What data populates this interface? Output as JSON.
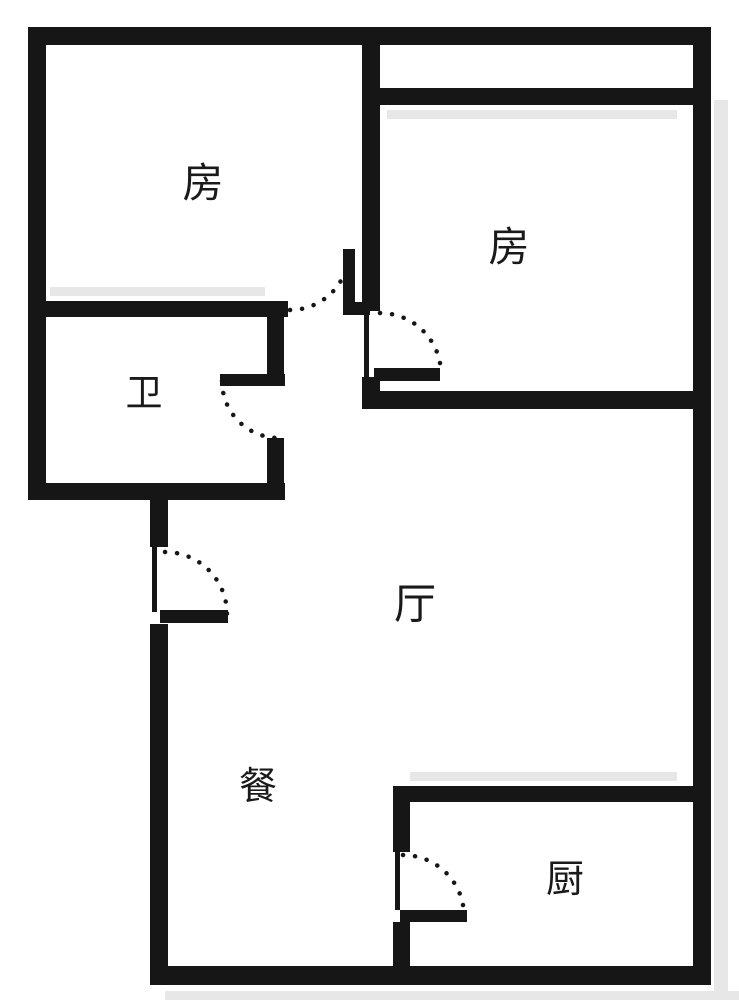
{
  "floor_plan": {
    "type": "apartment-floor-plan",
    "canvas": {
      "width": 739,
      "height": 1000
    },
    "colors": {
      "background": "#ffffff",
      "wall": "#161616",
      "shadow": "#e7e7e7",
      "text": "#1a1a1a"
    },
    "rooms": [
      {
        "id": "bedroom-left",
        "label": "房",
        "x": 203,
        "y": 183,
        "font": 41
      },
      {
        "id": "bedroom-right",
        "label": "房",
        "x": 509,
        "y": 247,
        "font": 41
      },
      {
        "id": "bathroom",
        "label": "卫",
        "x": 144,
        "y": 393,
        "font": 37
      },
      {
        "id": "living-room",
        "label": "厅",
        "x": 415,
        "y": 604,
        "font": 42
      },
      {
        "id": "dining",
        "label": "餐",
        "x": 258,
        "y": 787,
        "font": 38
      },
      {
        "id": "kitchen",
        "label": "厨",
        "x": 565,
        "y": 880,
        "font": 38
      }
    ],
    "walls": [
      {
        "name": "outer-wall-top",
        "x": 28,
        "y": 27,
        "w": 683,
        "h": 18
      },
      {
        "name": "outer-wall-left",
        "x": 28,
        "y": 27,
        "w": 18,
        "h": 473
      },
      {
        "name": "outer-wall-right",
        "x": 693,
        "y": 27,
        "w": 18,
        "h": 958
      },
      {
        "name": "outer-wall-bottom",
        "x": 150,
        "y": 966,
        "w": 561,
        "h": 19
      },
      {
        "name": "hall-left-wall-upper",
        "x": 150,
        "y": 483,
        "w": 18,
        "h": 64
      },
      {
        "name": "hall-left-wall-lower",
        "x": 150,
        "y": 624,
        "w": 18,
        "h": 344
      },
      {
        "name": "bathroom-top-wall",
        "x": 28,
        "y": 301,
        "w": 260,
        "h": 16
      },
      {
        "name": "bathroom-right-wall-upper",
        "x": 267,
        "y": 317,
        "w": 17,
        "h": 58
      },
      {
        "name": "bathroom-right-wall-lower",
        "x": 267,
        "y": 438,
        "w": 17,
        "h": 62
      },
      {
        "name": "bathroom-bottom-wall",
        "x": 28,
        "y": 483,
        "w": 257,
        "h": 17
      },
      {
        "name": "divider-wall-upper",
        "x": 362,
        "y": 27,
        "w": 18,
        "h": 284
      },
      {
        "name": "divider-wall-lower",
        "x": 362,
        "y": 377,
        "w": 18,
        "h": 32
      },
      {
        "name": "bedroom-right-top-wall",
        "x": 375,
        "y": 88,
        "w": 322,
        "h": 17
      },
      {
        "name": "bedroom-right-bottom-wall",
        "x": 362,
        "y": 391,
        "w": 349,
        "h": 18
      },
      {
        "name": "kitchen-top-wall",
        "x": 393,
        "y": 786,
        "w": 318,
        "h": 16
      },
      {
        "name": "kitchen-left-wall-upper",
        "x": 393,
        "y": 802,
        "w": 17,
        "h": 50
      },
      {
        "name": "kitchen-left-wall-lower",
        "x": 393,
        "y": 922,
        "w": 17,
        "h": 46
      },
      {
        "name": "bedroom-left-door-stub",
        "x": 343,
        "y": 302,
        "w": 27,
        "h": 13
      }
    ],
    "door_jambs": [
      {
        "name": "entry-door-jamb",
        "x": 152,
        "y": 547,
        "w": 5,
        "h": 65
      },
      {
        "name": "bedroom-right-door-jamb",
        "x": 364,
        "y": 313,
        "w": 5,
        "h": 64
      },
      {
        "name": "kitchen-door-jamb",
        "x": 395,
        "y": 852,
        "w": 5,
        "h": 58
      }
    ],
    "door_leaves": [
      {
        "name": "bedroom-left-door-leaf",
        "x": 343,
        "y": 249,
        "w": 12,
        "h": 61
      },
      {
        "name": "bedroom-right-door-leaf",
        "x": 374,
        "y": 368,
        "w": 66,
        "h": 13
      },
      {
        "name": "bathroom-door-leaf",
        "x": 220,
        "y": 374,
        "w": 65,
        "h": 12
      },
      {
        "name": "entry-door-leaf",
        "x": 160,
        "y": 610,
        "w": 68,
        "h": 13
      },
      {
        "name": "kitchen-door-leaf",
        "x": 400,
        "y": 910,
        "w": 67,
        "h": 12
      }
    ],
    "door_arcs": [
      {
        "name": "bedroom-left-door-arc",
        "path": "M290,310 A59,59 0 0 0 349,251"
      },
      {
        "name": "bedroom-right-door-arc",
        "path": "M380,313 A61,61 0 0 1 441,374"
      },
      {
        "name": "bathroom-door-arc",
        "path": "M222,381 A57,57 0 0 0 279,438"
      },
      {
        "name": "entry-door-arc",
        "path": "M165,552 A62,62 0 0 1 227,614"
      },
      {
        "name": "kitchen-door-arc",
        "path": "M403,855 A61,61 0 0 1 464,916"
      }
    ],
    "shadows": [
      {
        "name": "shadow-bathroom-top",
        "x": 50,
        "y": 287,
        "w": 215,
        "h": 9
      },
      {
        "name": "shadow-bedroom-right",
        "x": 387,
        "y": 110,
        "w": 290,
        "h": 9
      },
      {
        "name": "shadow-kitchen-top",
        "x": 410,
        "y": 772,
        "w": 267,
        "h": 9
      },
      {
        "name": "shadow-right-wall",
        "x": 714,
        "y": 100,
        "w": 14,
        "h": 891
      },
      {
        "name": "shadow-bottom-wall",
        "x": 165,
        "y": 991,
        "w": 574,
        "h": 9
      }
    ]
  }
}
